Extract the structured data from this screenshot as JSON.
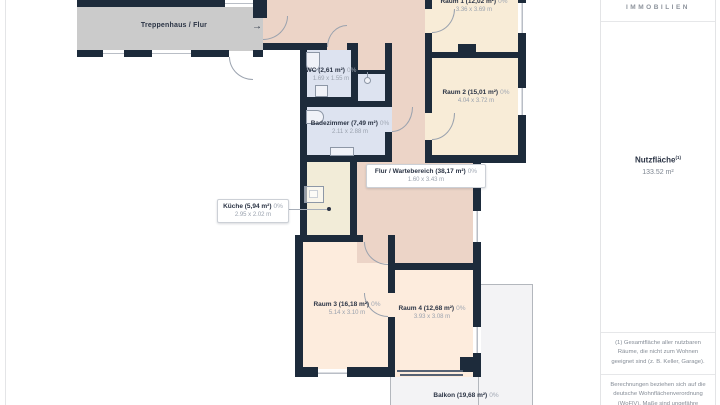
{
  "sidebar": {
    "brand": "IMMOBILIEN",
    "metric_label": "Nutzfläche",
    "metric_sup": "(1)",
    "metric_value": "133.52 m²",
    "footnote1": "(1) Gesamtfläche aller nutzbaren Räume, die nicht zum Wohnen geeignet sind (z. B. Keller, Garage).",
    "footnote2": "Berechnungen beziehen sich auf die deutsche Wohnflächenverordnung (WoFlV). Maße sind ungefähre Angaben"
  },
  "floorplan": {
    "entry_arrow": "→",
    "rooms": {
      "treppenhaus": {
        "label": "Treppenhaus / Flur"
      },
      "raum1": {
        "label": "Raum 1 (12,02 m²)",
        "pct": "0%",
        "dims": "3.36 x 3.69 m"
      },
      "raum2": {
        "label": "Raum 2 (15,01 m²)",
        "pct": "0%",
        "dims": "4.04 x 3.72 m"
      },
      "wc": {
        "label": "WC (2,61 m²)",
        "pct": "0%",
        "dims": "1.69 x 1.55 m"
      },
      "bad": {
        "label": "Badezimmer (7,49 m²)",
        "pct": "0%",
        "dims": "2.11 x 2.88 m"
      },
      "kueche": {
        "label": "Küche (5,94 m²)",
        "pct": "0%",
        "dims": "2.95 x 2.02 m"
      },
      "flur": {
        "label": "Flur / Wartebereich (38,17 m²)",
        "pct": "0%",
        "dims": "1.60 x 3.43 m"
      },
      "raum3": {
        "label": "Raum 3 (16,18 m²)",
        "pct": "0%",
        "dims": "5.14 x 3.10 m"
      },
      "raum4": {
        "label": "Raum 4 (12,68 m²)",
        "pct": "0%",
        "dims": "3.93 x 3.08 m"
      },
      "balkon": {
        "label": "Balkon (19,68 m²)",
        "pct": "0%"
      }
    },
    "colors": {
      "wall": "#1d2b3b",
      "corridor": "#cbcbcb",
      "hallway": "#ecd4c7",
      "room_cream": "#f8ecd7",
      "room_peach": "#fdecdd",
      "kitchen": "#f2ecd8",
      "wet_rooms": "#dde3f0",
      "balcony": "#f3f3f5"
    }
  }
}
